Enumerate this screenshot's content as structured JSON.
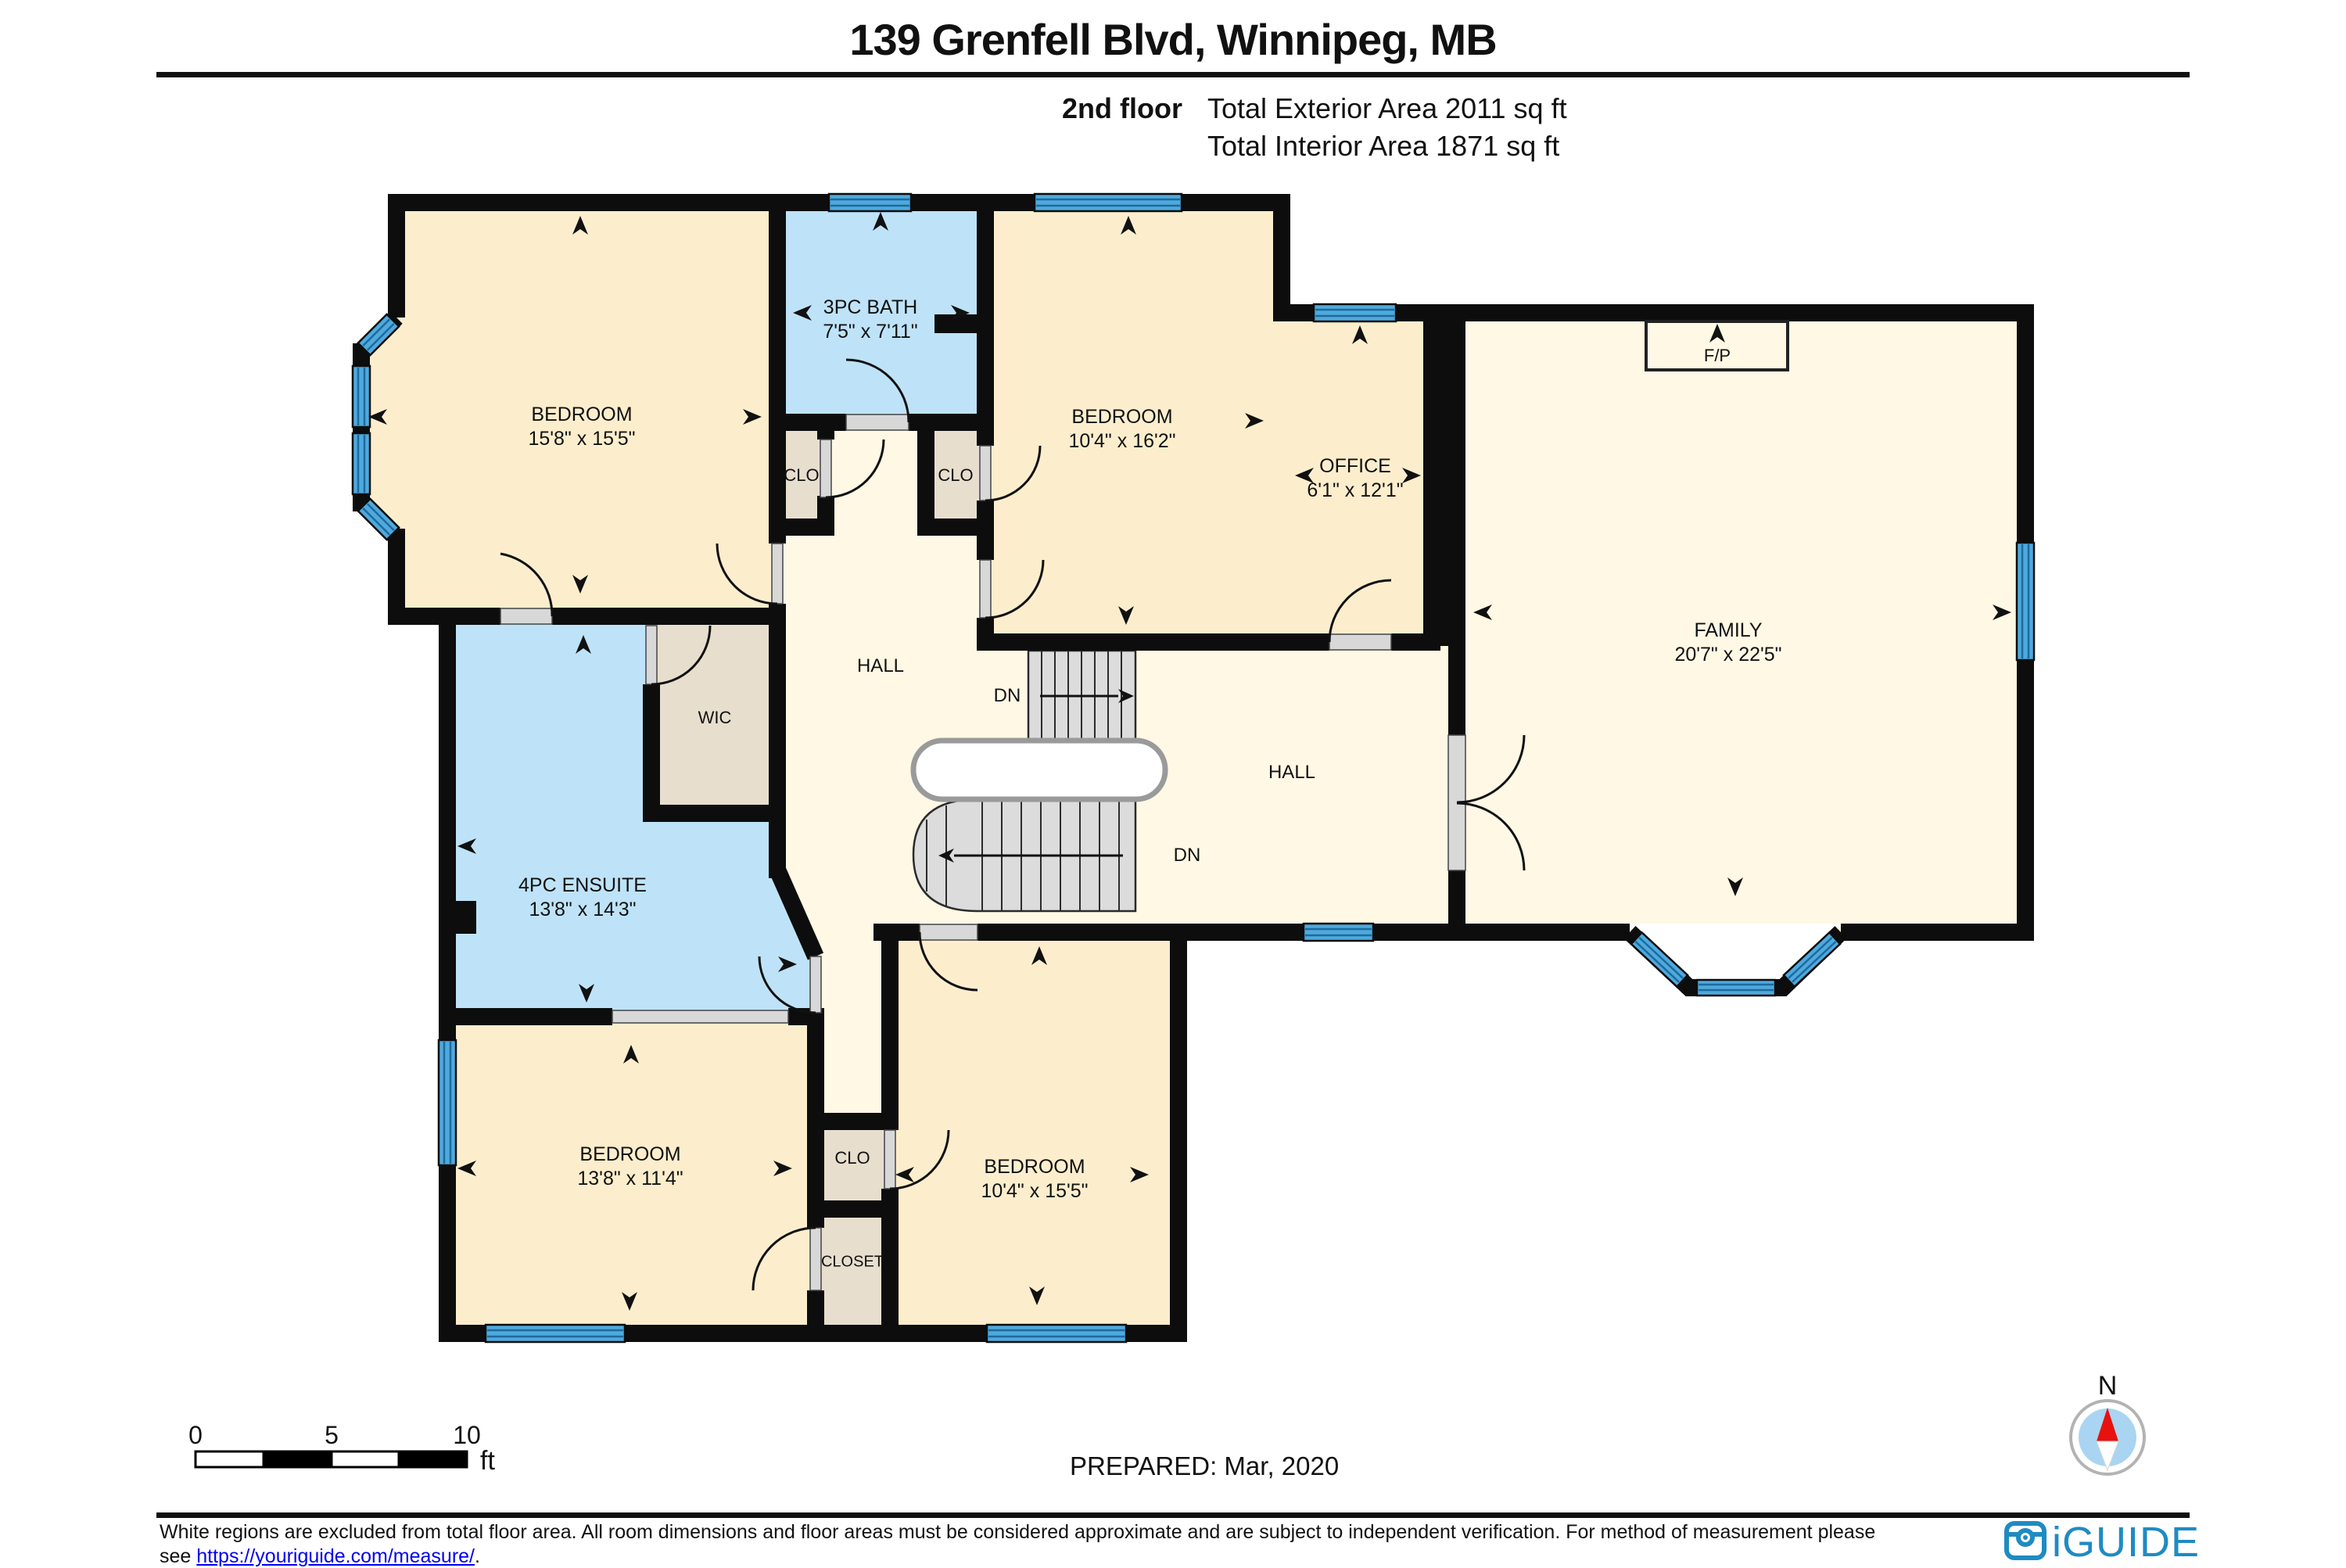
{
  "header": {
    "title": "139 Grenfell Blvd, Winnipeg, MB",
    "floor_label": "2nd floor",
    "exterior_area": "Total Exterior Area 2011 sq ft",
    "interior_area": "Total Interior Area 1871 sq ft"
  },
  "rooms": {
    "bedroom1": {
      "name": "BEDROOM",
      "dims": "15'8\" x 15'5\""
    },
    "bath": {
      "name": "3PC BATH",
      "dims": "7'5\" x 7'11\""
    },
    "bedroom2": {
      "name": "BEDROOM",
      "dims": "10'4\" x 16'2\""
    },
    "office": {
      "name": "OFFICE",
      "dims": "6'1\" x 12'1\""
    },
    "family": {
      "name": "FAMILY",
      "dims": "20'7\" x 22'5\""
    },
    "ensuite": {
      "name": "4PC ENSUITE",
      "dims": "13'8\" x 14'3\""
    },
    "bedroom3": {
      "name": "BEDROOM",
      "dims": "13'8\" x 11'4\""
    },
    "bedroom4": {
      "name": "BEDROOM",
      "dims": "10'4\" x 15'5\""
    }
  },
  "labels": {
    "hall": "HALL",
    "wic": "WIC",
    "clo": "CLO",
    "closet": "CLOSET",
    "fireplace": "F/P",
    "down": "DN"
  },
  "scale_bar": {
    "zero": "0",
    "five": "5",
    "ten": "10",
    "unit": "ft"
  },
  "compass": {
    "north": "N"
  },
  "footer": {
    "prepared": "PREPARED: Mar, 2020",
    "disclaimer_1": "White regions are excluded from total floor area. All room dimensions and floor areas must be considered approximate and are subject to independent verification. For method of measurement please",
    "see_prefix": "see ",
    "measure_url": "https://youriguide.com/measure/",
    "period": ".",
    "brand": "iGUIDE"
  },
  "colors": {
    "room_cream": "#FCEECD",
    "hall_cream": "#FFF8E5",
    "wet_blue": "#BEE3F8",
    "closet_beige": "#E7DECE",
    "window_blue": "#4FA9DC",
    "brand_blue": "#1E8BC3",
    "wall_black": "#0D0D0D",
    "compass_red": "#E8110D",
    "compass_disc": "#A9D5F2"
  }
}
